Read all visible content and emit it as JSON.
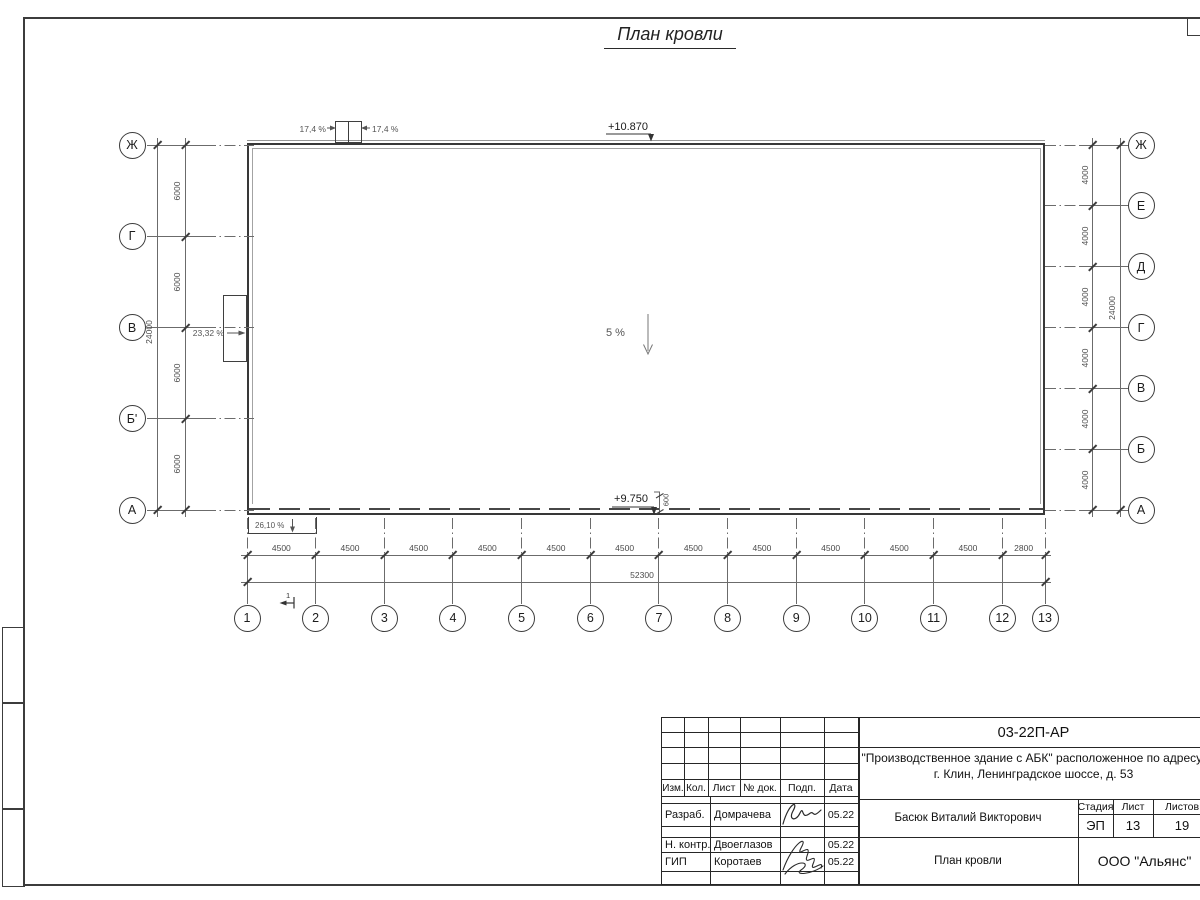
{
  "drawing": {
    "title": "План кровли",
    "elevation_top": "+10.870",
    "elevation_bottom": "+9.750",
    "slope_center": "5 %",
    "slope_left": "23,32 %",
    "slope_bottom_left": "26,10 %",
    "hatch_slope_left": "17,4 %",
    "hatch_slope_right": "17,4 %",
    "overhang_dim": "600",
    "section_mark": "1",
    "axes_left": {
      "labels": [
        "Ж",
        "Г",
        "В",
        "Б'",
        "А"
      ],
      "segments": [
        "6000",
        "6000",
        "6000",
        "6000"
      ],
      "total": "24000"
    },
    "axes_right": {
      "labels": [
        "Ж",
        "Е",
        "Д",
        "Г",
        "В",
        "Б",
        "А"
      ],
      "segments": [
        "4000",
        "4000",
        "4000",
        "4000",
        "4000",
        "4000"
      ],
      "total": "24000"
    },
    "axes_bottom": {
      "labels": [
        "1",
        "2",
        "3",
        "4",
        "5",
        "6",
        "7",
        "8",
        "9",
        "10",
        "11",
        "12",
        "13"
      ],
      "segments": [
        "4500",
        "4500",
        "4500",
        "4500",
        "4500",
        "4500",
        "4500",
        "4500",
        "4500",
        "4500",
        "4500",
        "2800"
      ],
      "total": "52300"
    }
  },
  "title_block": {
    "doc_number": "03-22П-АР",
    "project_line1": "\"Производственное здание с АБК\" расположенное по адресу:",
    "project_line2": "г. Клин, Ленинградское шоссе, д. 53",
    "columns": [
      "Изм.",
      "Кол.",
      "Лист",
      "№ док.",
      "Подп.",
      "Дата"
    ],
    "signature_rows": [
      {
        "role": "Разраб.",
        "name": "Домрачева",
        "date": "05.22"
      },
      {
        "role": "Н. контр.",
        "name": "Двоеглазов",
        "date": "05.22"
      },
      {
        "role": "ГИП",
        "name": "Коротаев",
        "date": "05.22"
      }
    ],
    "approver": "Басюк Виталий Викторович",
    "stage_label": "Стадия",
    "sheet_label": "Лист",
    "sheets_label": "Листов",
    "stage": "ЭП",
    "sheet_number": "13",
    "sheets_total": "19",
    "drawing_name": "План кровли",
    "company": "ООО \"Альянс\""
  }
}
